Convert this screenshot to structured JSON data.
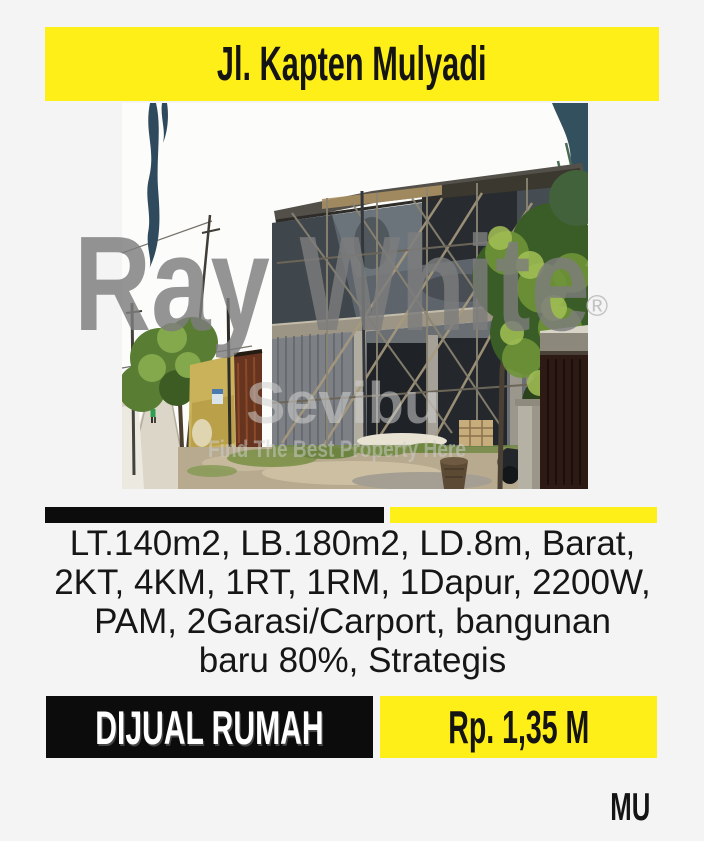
{
  "colors": {
    "background": "#f4f4f4",
    "brand_yellow": "#ffef18",
    "brand_black": "#0c0c0c",
    "text_dark": "#161616",
    "text_white": "#ffffff",
    "watermark_gray": "#7d7d7d"
  },
  "header": {
    "title": "Jl. Kapten Mulyadi"
  },
  "photo": {
    "subject": "two-story-house-under-construction-with-scaffolding",
    "watermark_main": "Ray White",
    "watermark_reg": "®",
    "watermark_secondary": "Sevibu",
    "watermark_tagline": "Find The Best Property Here"
  },
  "description": {
    "lines": [
      "LT.140m2, LB.180m2, LD.8m, Barat,",
      "2KT, 4KM, 1RT, 1RM, 1Dapur, 2200W,",
      "PAM, 2Garasi/Carport, bangunan",
      "baru 80%, Strategis"
    ],
    "full_text": "LT.140m2, LB.180m2, LD.8m, Barat, 2KT, 4KM, 1RT, 1RM, 1Dapur, 2200W, PAM, 2Garasi/Carport, bangunan baru 80%, Strategis"
  },
  "footer": {
    "status_label": "DIJUAL RUMAH",
    "price_label": "Rp. 1,35 M",
    "agent_initials": "MU"
  }
}
